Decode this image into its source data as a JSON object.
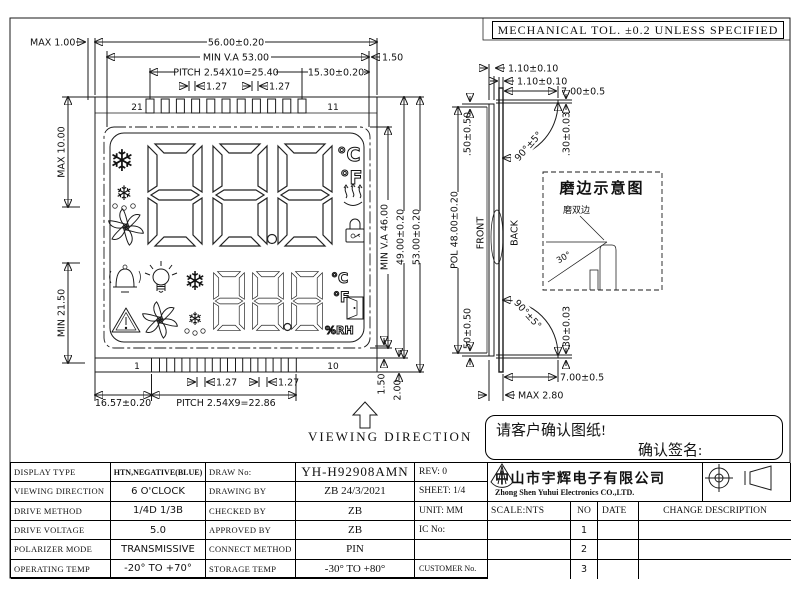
{
  "frame": {
    "tol_note": "MECHANICAL TOL. ±0.2 UNLESS SPECIFIED"
  },
  "front": {
    "dim_max100": "MAX 1.00",
    "dim_w": "56.00±0.20",
    "dim_va_w": "MIN V.A 53.00",
    "dim_pitch_top": "PITCH 2.54X10=25.40",
    "dim_1530": "15.30±0.20",
    "dim_150_top": "1.50",
    "dim_127_tl": "1.27",
    "dim_127_tr": "1.27",
    "dim_max10": "MAX 10.00",
    "dim_min2150": "MIN 21.50",
    "dim_va_h": "MIN V.A 46.00",
    "dim_h49": "49.00±0.20",
    "dim_h53": "53.00±0.20",
    "dim_1657": "16.57±0.20",
    "dim_pitch_bot": "PITCH 2.54X9=22.86",
    "dim_127_bl": "1.27",
    "dim_127_br": "1.27",
    "dim_150_bot": "1.50",
    "dim_200": "2.00",
    "pin_top_first": "21",
    "pin_top_last": "11",
    "pin_bot_first": "1",
    "pin_bot_last": "10",
    "viewing_direction": "VIEWING DIRECTION",
    "lcd": {
      "deg_c": "°C",
      "deg_f": "°F",
      "deg_c2": "°C",
      "deg_f2": "°F",
      "rh": "%RH",
      "snow1": "❄",
      "snow2": "❄",
      "defrost1": "❄",
      "defrost2": "❄",
      "icons": [
        "snowflake",
        "defrost-drops",
        "fan",
        "heat-steam",
        "lock",
        "bell",
        "bulb",
        "snowflake",
        "warning-triangle",
        "fan",
        "defrost-drops",
        "door"
      ]
    }
  },
  "side": {
    "dim_110a": "1.10±0.10",
    "dim_110b": "1.10±0.10",
    "dim_700_top": "7.00±0.5",
    "dim_700_bot": "7.00±0.5",
    "dim_030_top": ".30±0.03",
    "dim_030_bot": ".30±0.03",
    "dim_050_top": ".50±0.50",
    "dim_050_bot": ".50±0.50",
    "dim_90_top": "90°±5°",
    "dim_90_bot": "90°±5°",
    "dim_pol": "POL 48.00±0.20",
    "dim_max280": "MAX 2.80",
    "front_label": "FRONT",
    "back_label": "BACK"
  },
  "edge_detail": {
    "title": "磨边示意图",
    "note": "磨双边",
    "angle": "30°"
  },
  "confirm": {
    "line1": "请客户确认图纸!",
    "line2": "确认签名:"
  },
  "table": {
    "specs": [
      {
        "label": "DISPLAY TYPE",
        "value": "HTN,NEGATIVE(BLUE)"
      },
      {
        "label": "VIEWING DIRECTION",
        "value": "6 O'CLOCK"
      },
      {
        "label": "DRIVE METHOD",
        "value": "1/4D  1/3B"
      },
      {
        "label": "DRIVE VOLTAGE",
        "value": "5.0"
      },
      {
        "label": "POLARIZER MODE",
        "value": "TRANSMISSIVE"
      },
      {
        "label": "OPERATING TEMP",
        "value": "-20° TO +70°"
      }
    ],
    "docs": [
      {
        "label": "DRAW No:",
        "value": "YH-H92908AMN"
      },
      {
        "label": "DRAWING BY",
        "value": "ZB   24/3/2021"
      },
      {
        "label": "CHECKED BY",
        "value": "ZB"
      },
      {
        "label": "APPROVED BY",
        "value": "ZB"
      },
      {
        "label": "CONNECT METHOD",
        "value": "PIN"
      },
      {
        "label": "STORAGE TEMP",
        "value": "-30° TO +80°"
      }
    ],
    "meta": [
      "REV:  0",
      "SHEET: 1/4",
      "UNIT: MM",
      "IC No:",
      "",
      "CUSTOMER No."
    ],
    "company": {
      "cn": "中山市宇辉电子有限公司",
      "en": "Zhong Shen Yuhui Electronics CO.,LTD."
    },
    "rev_header": {
      "scale": "SCALE:NTS",
      "no": "NO",
      "date": "DATE",
      "change": "CHANGE DESCRIPTION"
    },
    "rev_rows": [
      "1",
      "2",
      "3"
    ]
  }
}
